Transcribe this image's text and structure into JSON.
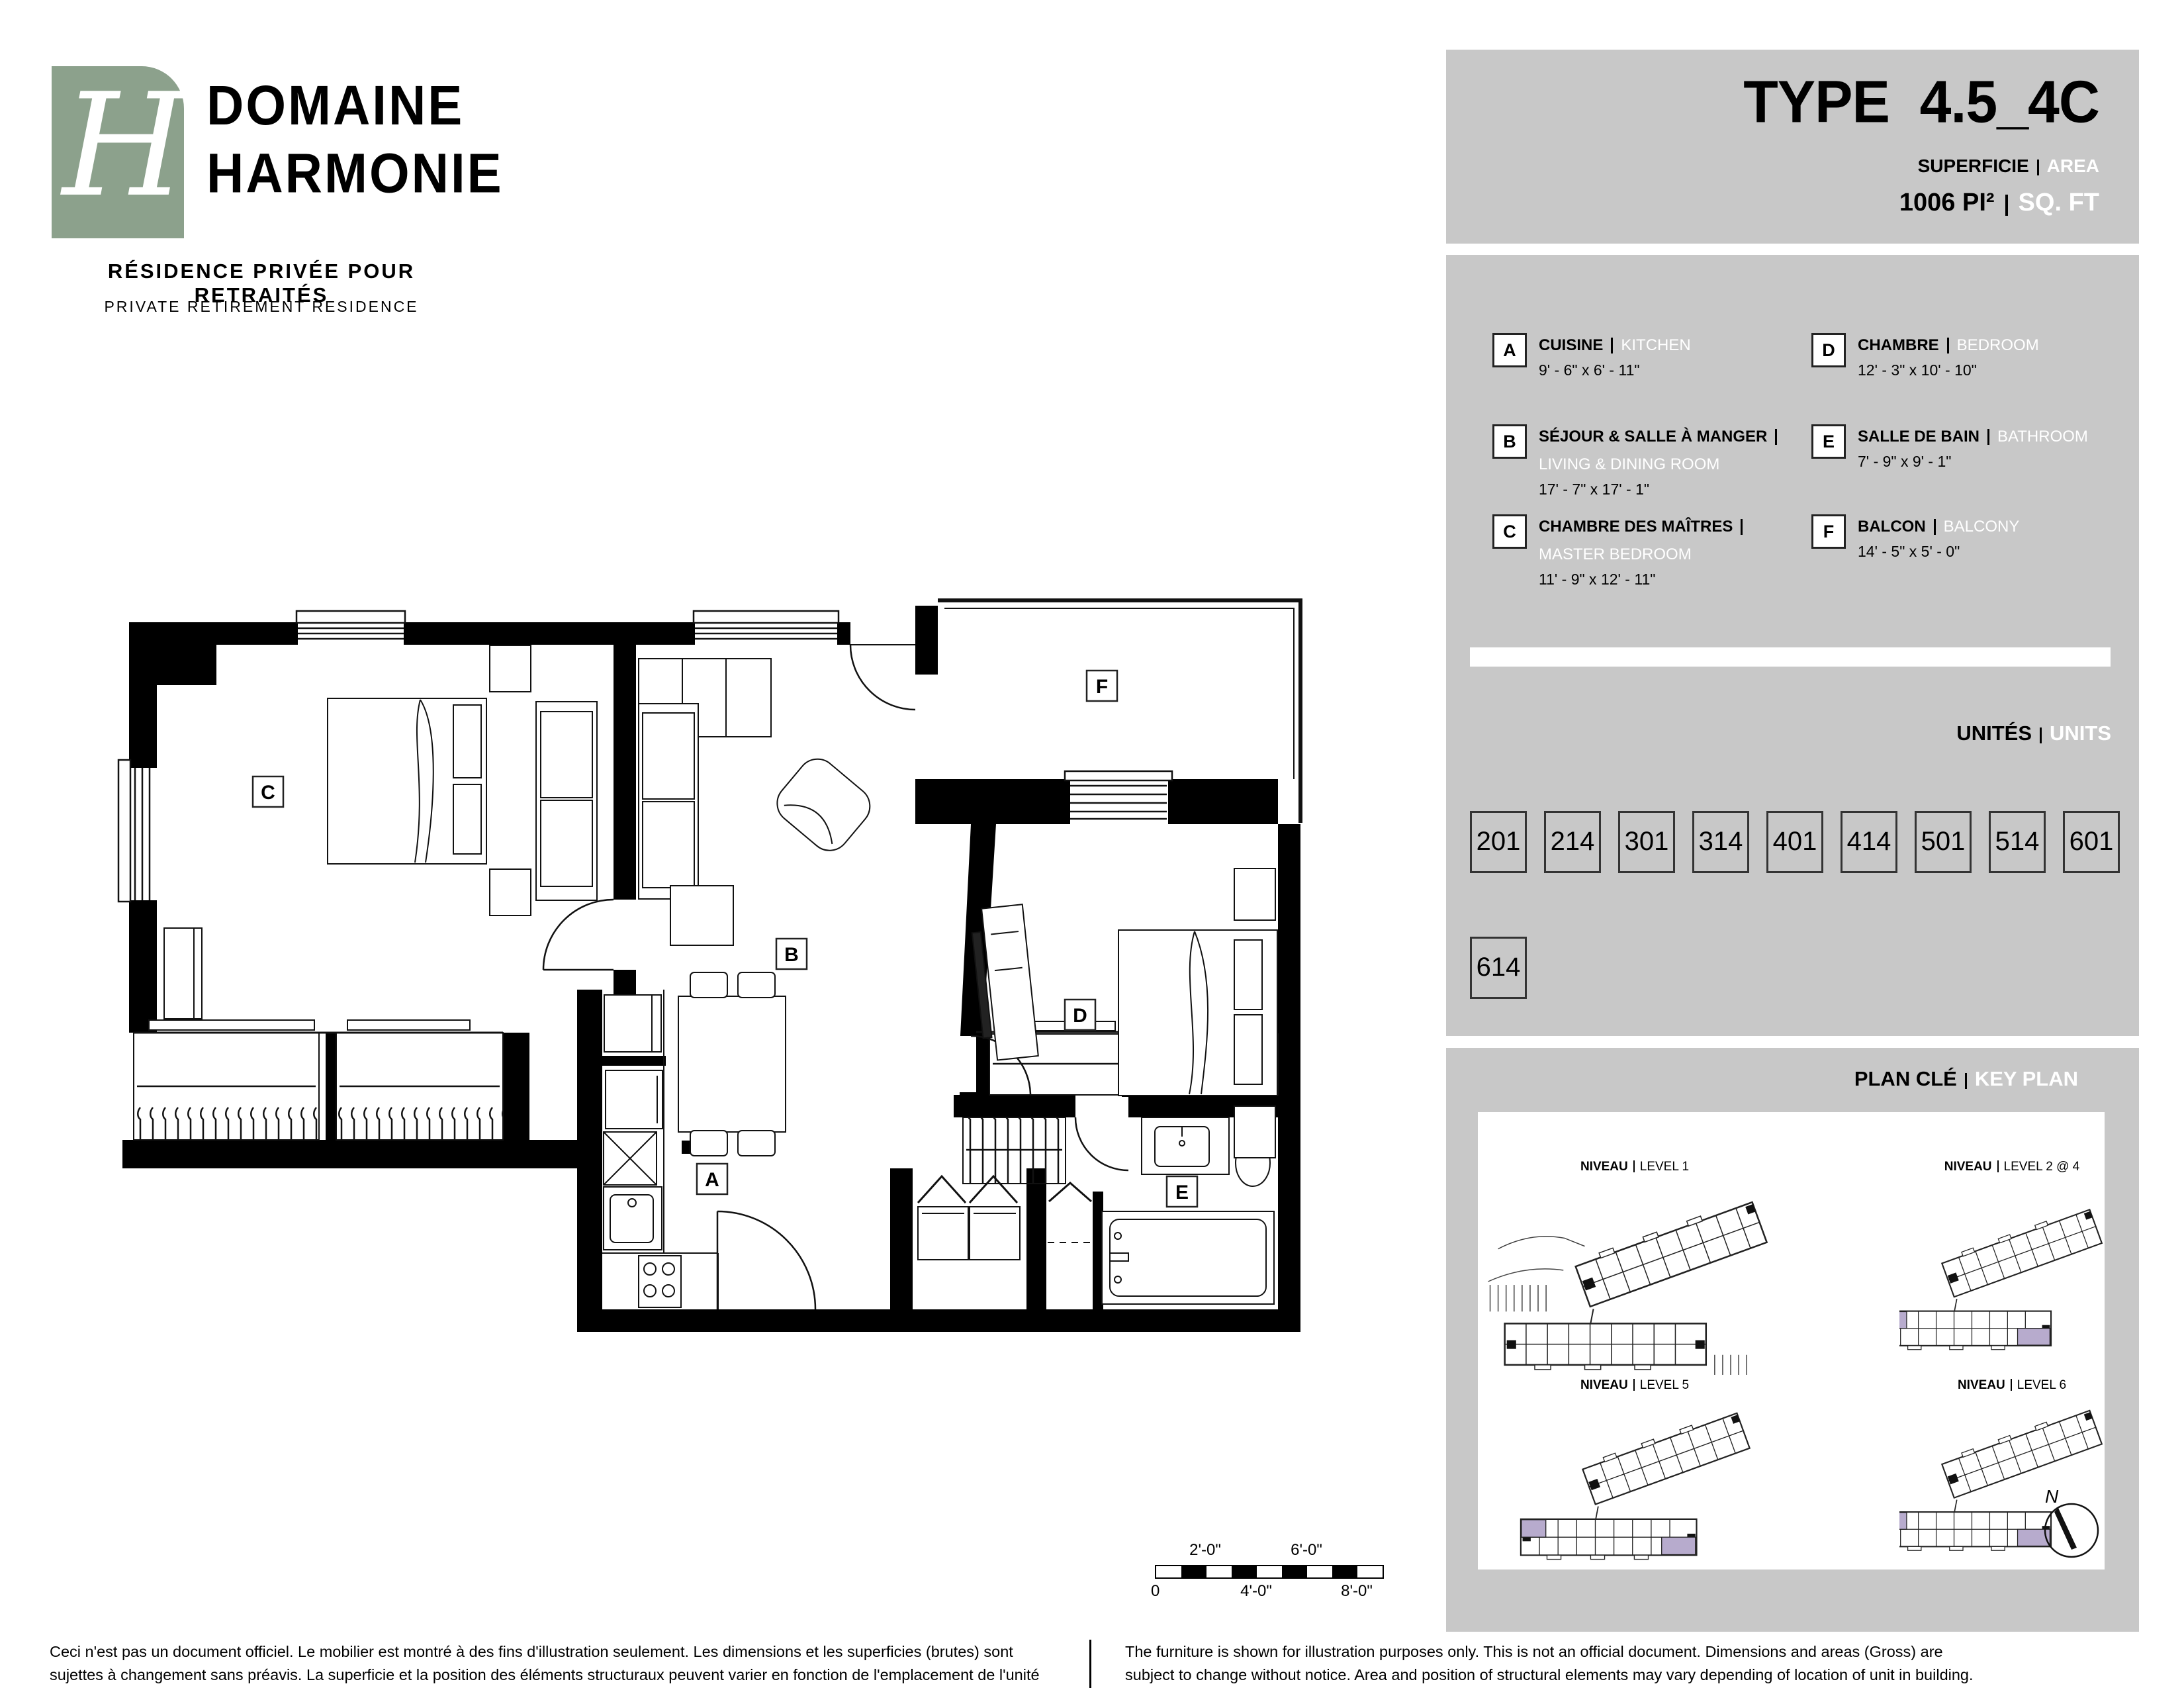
{
  "logo": {
    "monogram": "H",
    "name_line1": "DOMAINE",
    "name_line2": "HARMONIE",
    "tagline_fr": "RÉSIDENCE PRIVÉE POUR RETRAITÉS",
    "tagline_en": "PRIVATE RETIREMENT RESIDENCE"
  },
  "header": {
    "type_label": "TYPE",
    "type_value": "4.5_4C",
    "area_label_fr": "SUPERFICIE",
    "area_label_en": "AREA",
    "area_value": "1006",
    "area_unit_fr": "PI²",
    "area_unit_en": "SQ. FT"
  },
  "legend": {
    "items": [
      {
        "letter": "A",
        "name_fr": "CUISINE",
        "name_en": "KITCHEN",
        "dims": "9' - 6\" x 6' - 11\""
      },
      {
        "letter": "B",
        "name_fr": "SÉJOUR & SALLE À MANGER",
        "name_en": "LIVING & DINING ROOM",
        "dims": "17' - 7\" x 17' - 1\""
      },
      {
        "letter": "C",
        "name_fr": "CHAMBRE DES MAÎTRES",
        "name_en": "MASTER BEDROOM",
        "dims": "11' - 9\" x 12' - 11\""
      },
      {
        "letter": "D",
        "name_fr": "CHAMBRE",
        "name_en": "BEDROOM",
        "dims": "12' - 3\" x 10' - 10\""
      },
      {
        "letter": "E",
        "name_fr": "SALLE DE BAIN",
        "name_en": "BATHROOM",
        "dims": "7' - 9\" x 9' - 1\""
      },
      {
        "letter": "F",
        "name_fr": "BALCON",
        "name_en": "BALCONY",
        "dims": "14' - 5\" x 5' - 0\""
      }
    ]
  },
  "units": {
    "title_fr": "UNITÉS",
    "title_en": "UNITS",
    "list": [
      "201",
      "214",
      "301",
      "314",
      "401",
      "414",
      "501",
      "514",
      "601",
      "614"
    ]
  },
  "key_plan": {
    "title_fr": "PLAN CLÉ",
    "title_en": "KEY PLAN",
    "label_fr": "NIVEAU",
    "levels": [
      "LEVEL 1",
      "LEVEL 2 @ 4",
      "LEVEL 5",
      "LEVEL 6"
    ],
    "north_label": "N"
  },
  "floor_plan": {
    "rooms": [
      {
        "letter": "A"
      },
      {
        "letter": "B"
      },
      {
        "letter": "C"
      },
      {
        "letter": "D"
      },
      {
        "letter": "E"
      },
      {
        "letter": "F"
      }
    ]
  },
  "scale_bar": {
    "top_labels": [
      "2'-0\"",
      "6'-0\""
    ],
    "bottom_labels": [
      "0",
      "4'-0\"",
      "8'-0\""
    ]
  },
  "footer": {
    "fr": "Ceci n'est pas un document officiel.  Le mobilier est montré à des fins d'illustration seulement.  Les dimensions et les superficies (brutes) sont sujettes à changement sans préavis. La superficie et la position des éléments structuraux peuvent varier en fonction de l'emplacement de l'unité dans le bâtiment.",
    "en": "The furniture is shown for illustration purposes only.  This is not an official document.  Dimensions and areas (Gross) are subject to change without notice. Area and position of structural elements may vary depending of location of unit in building."
  },
  "colors": {
    "logo_green": "#8ca18c",
    "panel_gray": "#c8c8c8",
    "highlight_purple": "#b7abcd",
    "wall_black": "#000000"
  }
}
